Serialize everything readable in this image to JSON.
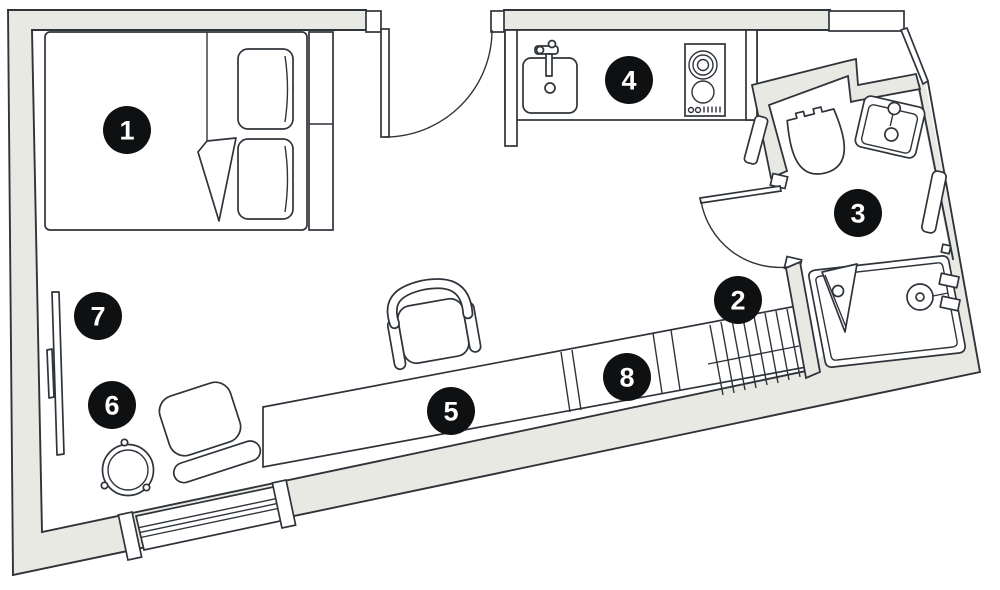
{
  "plan": {
    "markers": [
      {
        "label": "1"
      },
      {
        "label": "2"
      },
      {
        "label": "3"
      },
      {
        "label": "4"
      },
      {
        "label": "5"
      },
      {
        "label": "6"
      },
      {
        "label": "7"
      },
      {
        "label": "8"
      }
    ]
  },
  "colors": {
    "background": "#ffffff",
    "wall_fill": "#e9e9e3",
    "line": "#2f343a",
    "marker_background": "#0e1012",
    "marker_text": "#ffffff"
  }
}
